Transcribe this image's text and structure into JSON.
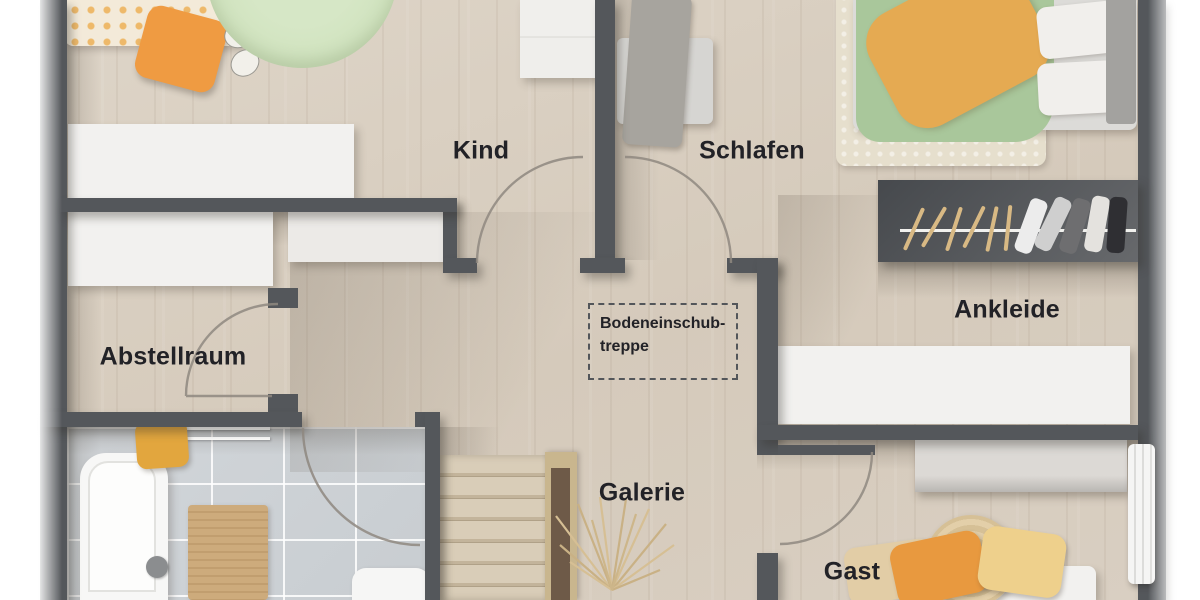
{
  "rooms": {
    "kind": {
      "label": "Kind"
    },
    "schlafen": {
      "label": "Schlafen"
    },
    "abstellraum": {
      "label": "Abstellraum"
    },
    "ankleide": {
      "label": "Ankleide"
    },
    "galerie": {
      "label": "Galerie"
    },
    "gast": {
      "label": "Gast"
    }
  },
  "annotations": {
    "attic_hatch": {
      "line1": "Bodeneinschub-",
      "line2": "treppe"
    }
  },
  "palette": {
    "wall": "#54575b",
    "floor_wood": "#d8cec1",
    "bath_tile": "#ccd1d4",
    "furniture_white": "#f2f1ef",
    "duvet_green": "#a9c79b",
    "duvet_orange": "#e5aa52",
    "rug_green": "#cfe2bd",
    "pillow_orange": "#e8993f",
    "pillow_yellow": "#eed08c",
    "stairs_wood": "#d3c6b0",
    "label_text": "#222227"
  }
}
